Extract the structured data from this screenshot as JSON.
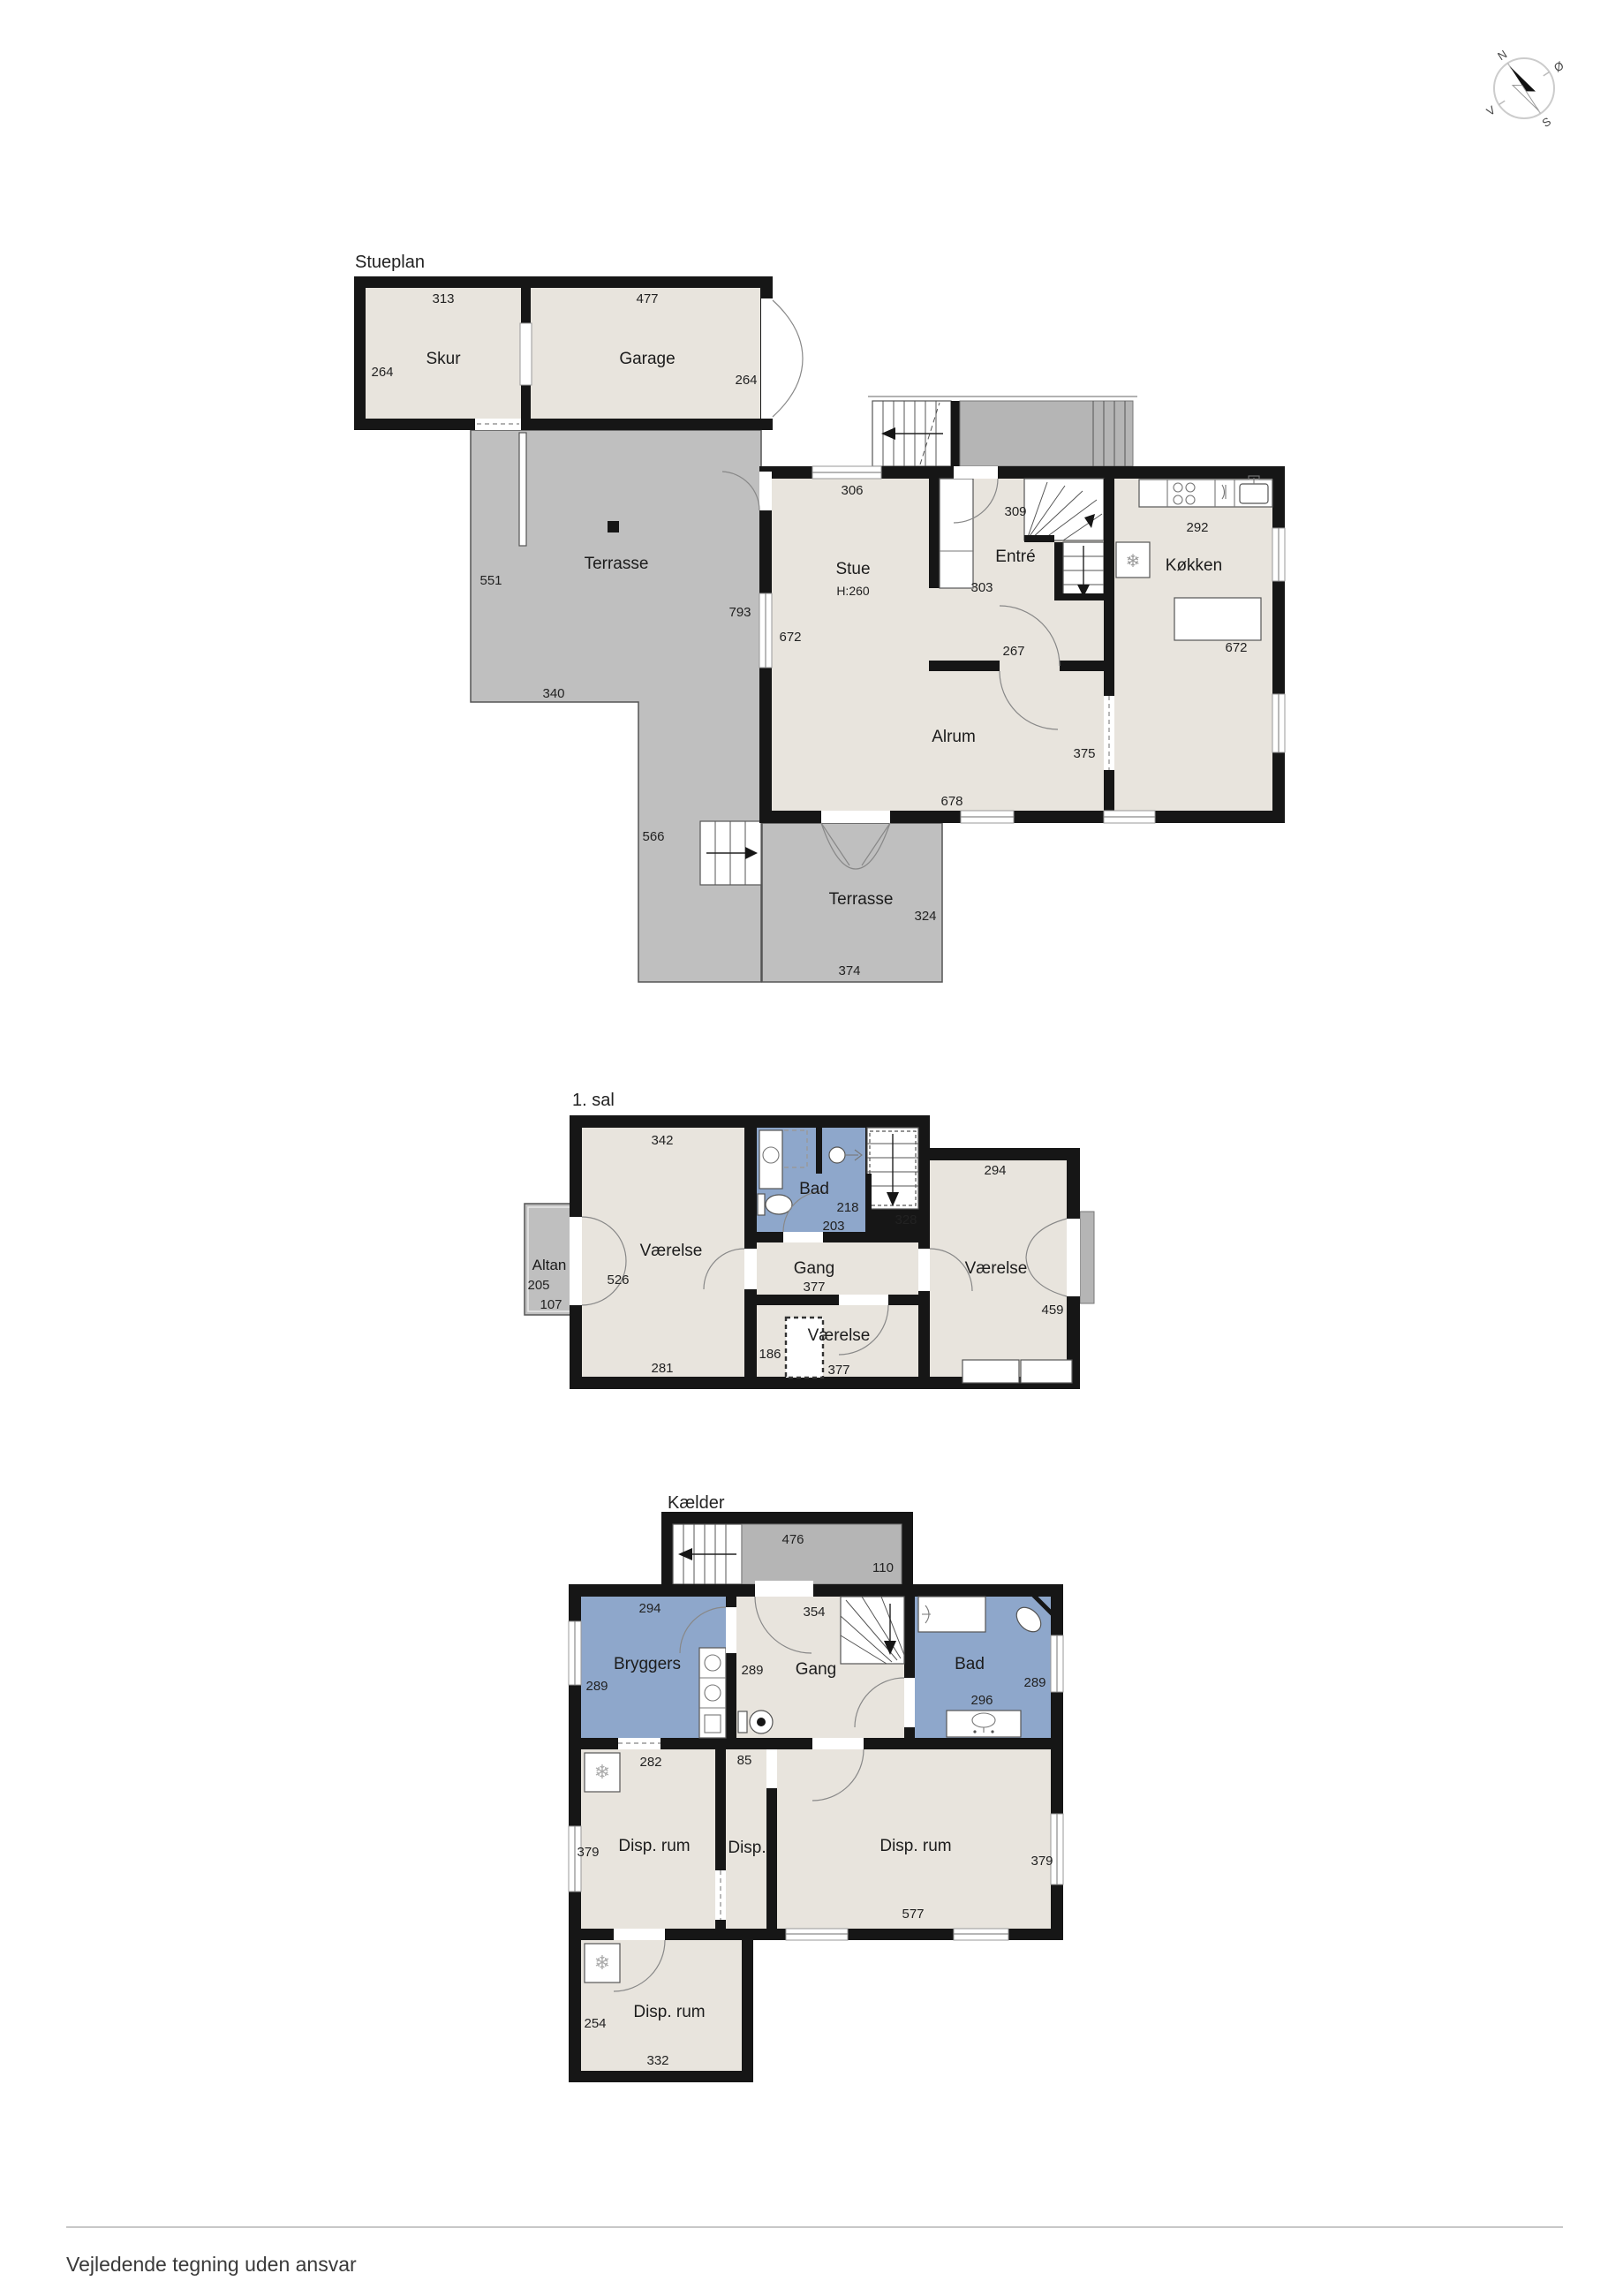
{
  "document": {
    "footer_disclaimer": "Vejledende tegning uden ansvar"
  },
  "compass": {
    "north": "N",
    "east": "Ø",
    "south": "S",
    "west": "V"
  },
  "icons": {
    "freezer": "❄"
  },
  "colors": {
    "wall": "#161616",
    "floor": "#e8e4dd",
    "wet_room": "#8ea7cb",
    "terrace": "#bfbfbf"
  },
  "floors": {
    "stueplan": {
      "title": "Stueplan",
      "rooms": {
        "skur": "Skur",
        "garage": "Garage",
        "terrasse_upper": "Terrasse",
        "stue": "Stue",
        "stue_height": "H:260",
        "entre": "Entré",
        "kokken": "Køkken",
        "alrum": "Alrum",
        "terrasse_lower": "Terrasse"
      },
      "dims": {
        "skur_width": "313",
        "skur_depth": "264",
        "garage_width": "477",
        "garage_depth": "264",
        "stue_width": "306",
        "entre_width": "309",
        "kokken_width": "292",
        "entre_depth": "303",
        "entre_opening": "267",
        "stue_depth": "672",
        "kokken_depth": "672",
        "terrasse_left": "551",
        "terrasse_height": "793",
        "terrasse_bottom": "340",
        "terrasse_side": "566",
        "alrum_width": "678",
        "alrum_opening": "375",
        "terrasse_lower_depth": "324",
        "terrasse_lower_width": "374"
      }
    },
    "first_floor": {
      "title": "1. sal",
      "rooms": {
        "altan": "Altan",
        "vaerelse_left": "Værelse",
        "bad": "Bad",
        "gang": "Gang",
        "vaerelse_middle": "Værelse",
        "vaerelse_right": "Værelse"
      },
      "dims": {
        "vaerelse_left_width": "342",
        "bad_width": "218",
        "bad_depth": "203",
        "stairs": "328",
        "vaerelse_right_width": "294",
        "altan_depth": "205",
        "altan_width": "107",
        "vaerelse_left_depth": "526",
        "gang_width": "377",
        "vaerelse_middle_offset": "186",
        "vaerelse_middle_width": "377",
        "vaerelse_left_bottom": "281",
        "vaerelse_right_depth": "459"
      }
    },
    "basement": {
      "title": "Kælder",
      "rooms": {
        "bryggers": "Bryggers",
        "gang": "Gang",
        "bad": "Bad",
        "disp_left": "Disp. rum",
        "disp_middle": "Disp.",
        "disp_right": "Disp. rum",
        "disp_bottom": "Disp. rum"
      },
      "dims": {
        "stairs_width": "476",
        "stairs_depth": "110",
        "bryggers_width": "294",
        "gang_width": "354",
        "bryggers_depth": "289",
        "gang_left": "289",
        "bad_depth": "289",
        "bad_fixture": "296",
        "disp_left_width": "282",
        "disp_middle_width": "85",
        "disp_left_depth": "379",
        "disp_right_width": "577",
        "disp_right_depth": "379",
        "disp_bottom_depth": "254",
        "disp_bottom_width": "332"
      }
    }
  }
}
